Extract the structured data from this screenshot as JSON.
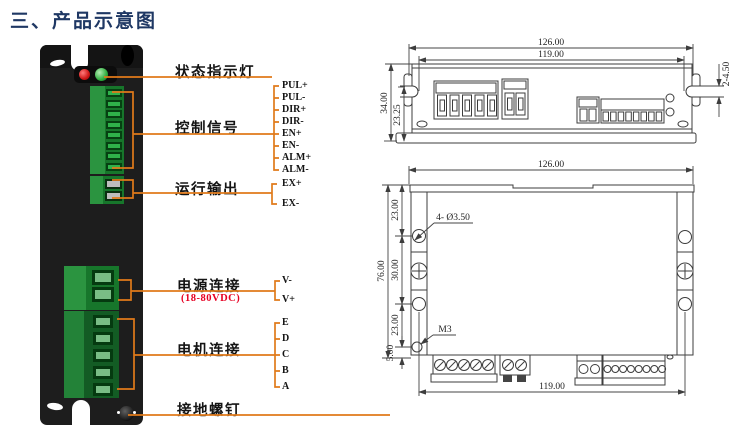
{
  "title": "三、产品示意图",
  "colors": {
    "accent_orange": "#e07a1a",
    "title_blue": "#1f3864",
    "warning_red": "#e60023",
    "device_green": "#17762b",
    "drawing_line": "#3d3d3d"
  },
  "front_panel": {
    "status_label": "状态指示灯",
    "control_label": "控制信号",
    "control_pins": [
      "PUL+",
      "PUL-",
      "DIR+",
      "DIR-",
      "EN+",
      "EN-",
      "ALM+",
      "ALM-"
    ],
    "output_label": "运行输出",
    "output_pins": [
      "EX+",
      "EX-"
    ],
    "power_label": "电源连接",
    "power_note": "(18-80VDC)",
    "power_pins": [
      "V-",
      "V+"
    ],
    "motor_label": "电机连接",
    "motor_pins": [
      "E",
      "D",
      "C",
      "B",
      "A"
    ],
    "ground_label": "接地螺钉"
  },
  "top_view_dims": {
    "overall_width": "126.00",
    "mount_width": "119.00",
    "overall_height": "34.00",
    "inner_height": "23.25",
    "slot": "2-4.50"
  },
  "front_view_dims": {
    "overall_width": "126.00",
    "mount_width": "119.00",
    "overall_height": "76.00",
    "top_offset": "23.00",
    "mid_span": "30.00",
    "bottom_offset": "23.00",
    "base_offset": "5.00",
    "mount_holes": "4- Ø3.50",
    "thread": "M3"
  }
}
